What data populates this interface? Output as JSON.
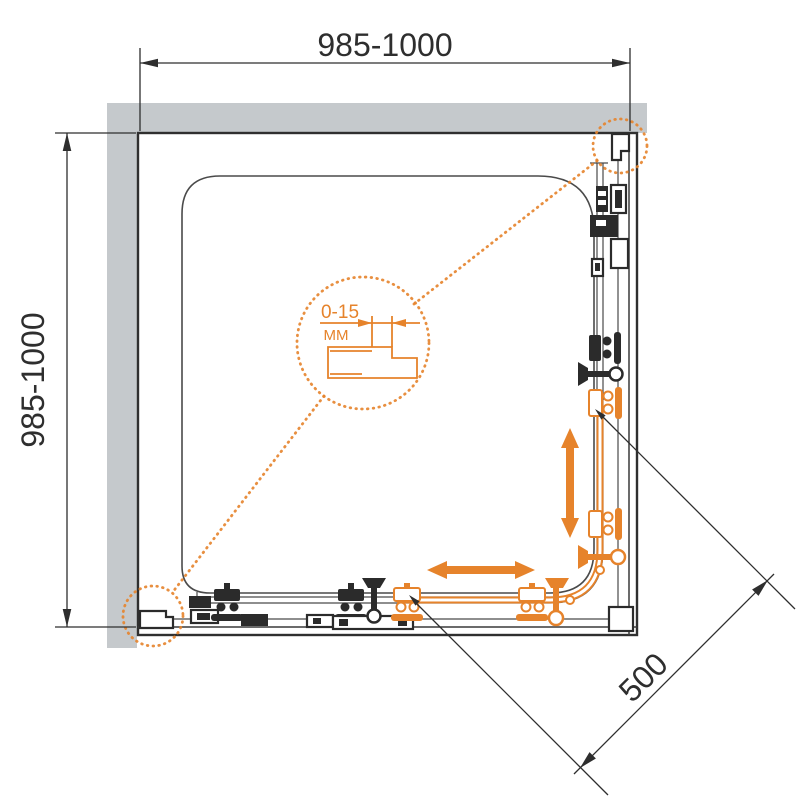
{
  "page": {
    "background": "#ffffff"
  },
  "colors": {
    "accent_orange": "#E6832B",
    "wall_gray": "#C5C9CC",
    "line_dark": "#2E2E2E"
  },
  "dimensions": {
    "top_width": {
      "label": "985-1000"
    },
    "left_height": {
      "label": "985-1000"
    },
    "diagonal_entry": {
      "label": "500"
    }
  },
  "detail_callout": {
    "adjustment_range": "0-15",
    "unit": "MM"
  }
}
